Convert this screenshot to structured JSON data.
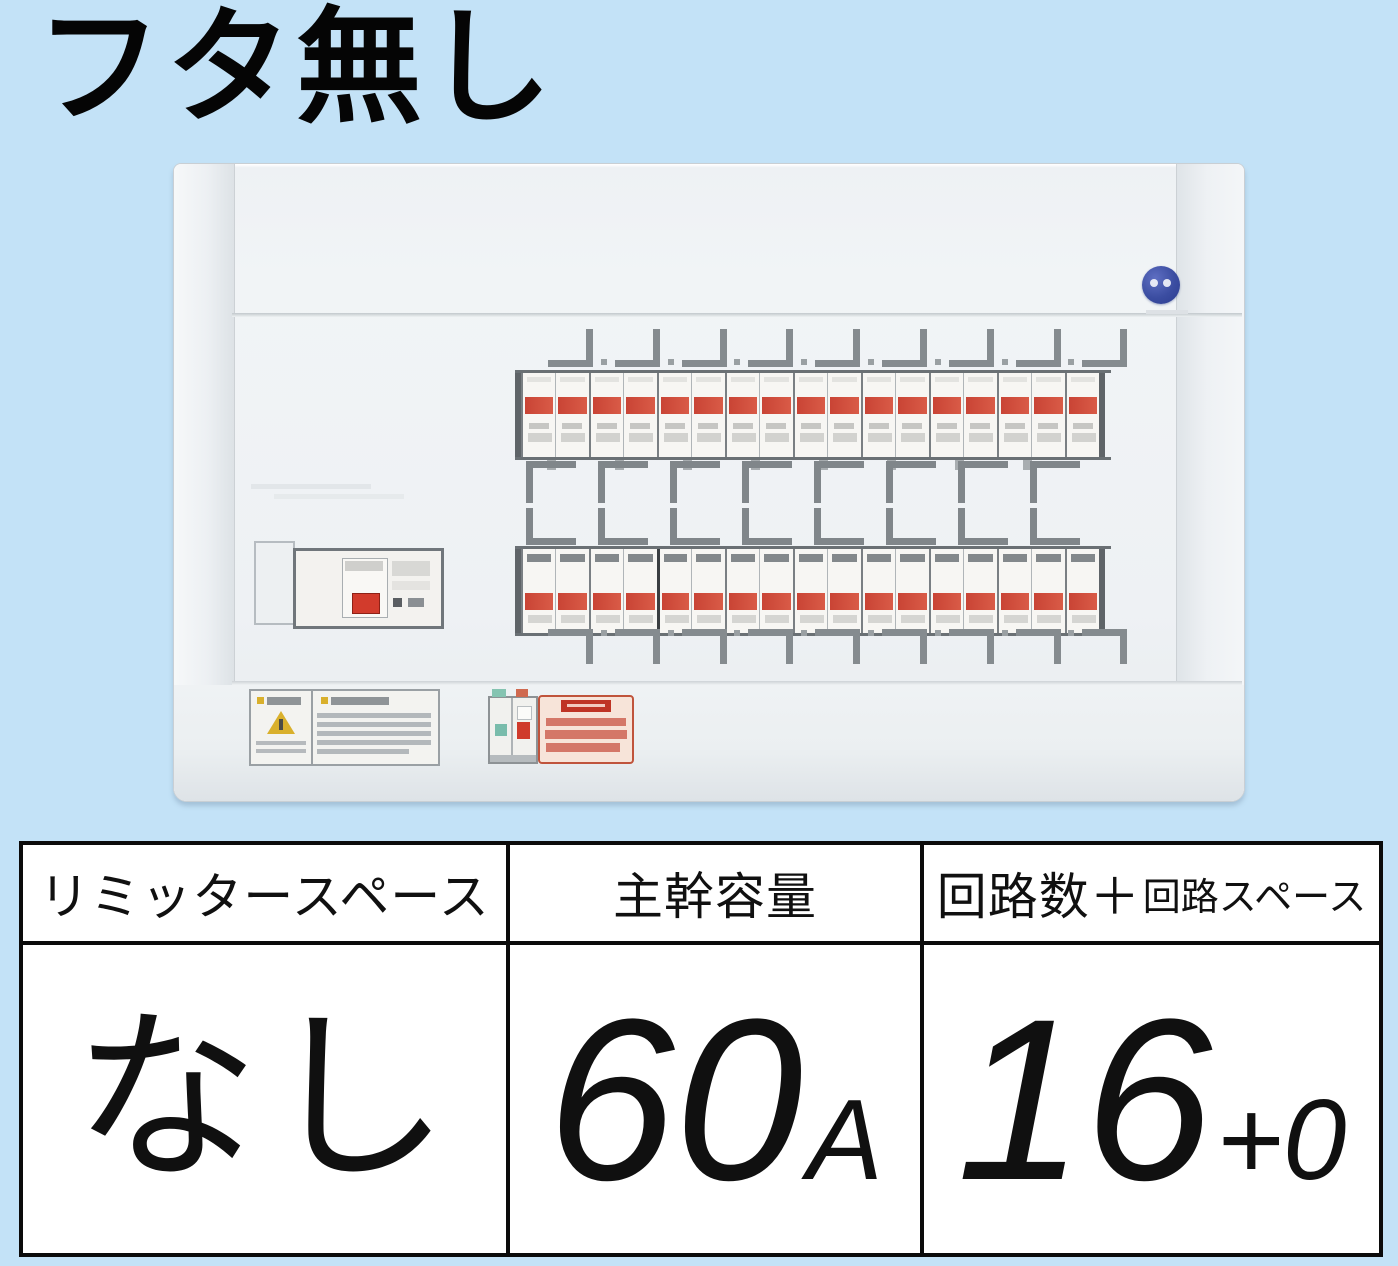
{
  "title": "フタ無し",
  "panel": {
    "description": "residential distribution board, two rows of branch breakers, main breaker unit at left, no cover",
    "branch_rows": 2,
    "modules_per_row": 17,
    "top_hooks": 9,
    "mid_hooks": 8,
    "bottom_hooks": 9,
    "colors": {
      "background_blue": "#c3e2f7",
      "panel_face": "#eff2f5",
      "breaker_band_red": "#c94435",
      "main_switch_red": "#d23b2c",
      "logo_blue": "#3b4da1",
      "caution_sticker_red": "#c0543c",
      "warning_yellow": "#d9b02c",
      "frame_gray": "#6a7074"
    }
  },
  "table": {
    "columns": [
      {
        "header": "リミッタースペース",
        "value": "なし"
      },
      {
        "header": "主幹容量",
        "value": "60",
        "value_suffix": "A"
      },
      {
        "header_main": "回路数＋",
        "header_sub": "回路スペース",
        "value": "16",
        "value_suffix": "+0"
      }
    ]
  }
}
